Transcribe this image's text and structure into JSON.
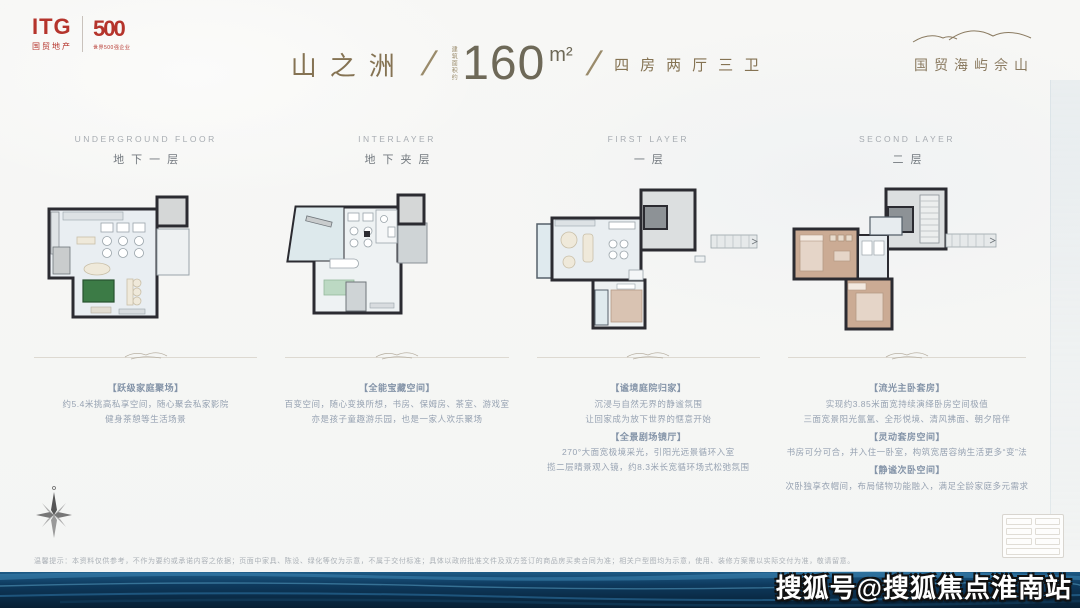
{
  "header": {
    "itg": {
      "logo": "ITG",
      "sub": "国贸地产",
      "badge": "500",
      "badge_sub": "世界500强企业"
    },
    "title": {
      "name": "山之洲",
      "slash": "/",
      "area_label": "建筑面积约",
      "area": "160",
      "unit": "m²",
      "rooms": "四房两厅三卫"
    },
    "project": "国贸海屿佘山"
  },
  "floors": [
    {
      "en": "UNDERGROUND FLOOR",
      "cn": "地下一层",
      "sections": [
        {
          "heading": "【跃级家庭聚场】",
          "lines": [
            "约5.4米挑高私享空间，随心聚会私家影院",
            "健身茶憩等生活场景"
          ]
        }
      ]
    },
    {
      "en": "INTERLAYER",
      "cn": "地下夹层",
      "sections": [
        {
          "heading": "【全能宝藏空间】",
          "lines": [
            "百变空间，随心变换所想，书房、保姆房、茶室、游戏室",
            "亦是孩子童趣游乐园，也是一家人欢乐聚场"
          ]
        }
      ]
    },
    {
      "en": "FIRST LAYER",
      "cn": "一层",
      "sections": [
        {
          "heading": "【谧境庭院归家】",
          "lines": [
            "沉浸与自然无界的静谧氛围",
            "让回家成为放下世界的惬意开始"
          ]
        },
        {
          "heading": "【全景剧场镜厅】",
          "lines": [
            "270°大面宽极境采光，引阳光远景循环入室",
            "揽二层晴景观入镜，约8.3米长宽循环场式松弛氛围"
          ]
        }
      ]
    },
    {
      "en": "SECOND LAYER",
      "cn": "二层",
      "sections": [
        {
          "heading": "【流光主卧套房】",
          "lines": [
            "实现约3.85米面宽持续演绎卧房空间极值",
            "三面宽景阳光氤氲、全形悦境、清风拂面、朝夕陪伴"
          ]
        },
        {
          "heading": "【灵动套房空间】",
          "lines": [
            "书房可分可合，并入住一卧室，构筑宽居容纳生活更多“变”法"
          ]
        },
        {
          "heading": "【静谧次卧空间】",
          "lines": [
            "次卧独享衣帽间，布局储物功能融入，满足全龄家庭多元需求"
          ]
        }
      ]
    }
  ],
  "footer": {
    "disclaimer": "温馨提示：本资料仅供参考，不作为要约或承诺内容之依据；页面中家具、陈设、绿化等仅为示意，不属于交付标准；具体以政府批准文件及双方签订的商品房买卖合同为准；相关户型图均为示意，使用、装修方案需以实际交付为准，敬请留意。",
    "watermark": "搜狐号@搜狐焦点淮南站"
  },
  "colors": {
    "accent_red": "#b5342c",
    "title_gold": "#857353",
    "wave_navy": "#0b2b46",
    "plan_wall": "#2b2b31",
    "plan_floor": "#e9eef2",
    "pool_green": "#3c7b46",
    "bedroom_tan": "#cbab94"
  }
}
